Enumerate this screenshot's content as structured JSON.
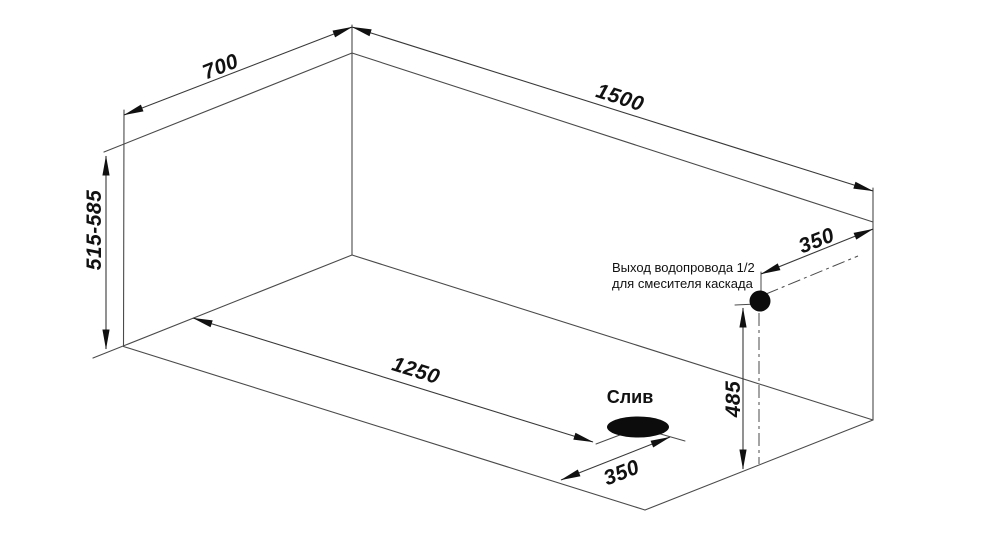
{
  "drawing": {
    "title_hint": "tank-dimension-drawing",
    "dimensions": {
      "width_top": "700",
      "length_top": "1500",
      "height_left": "515-585",
      "drain_from_left_wall": "1250",
      "drain_from_front_wall": "350",
      "outlet_from_back_wall": "350",
      "outlet_height_from_floor": "485"
    },
    "labels": {
      "drain": "Слив",
      "outlet_note_line1": "Выход водопровода 1/2",
      "outlet_note_line2": "для смесителя каскада"
    },
    "colors": {
      "background": "#ffffff",
      "line": "#4a4a4a",
      "ink": "#111111"
    }
  }
}
